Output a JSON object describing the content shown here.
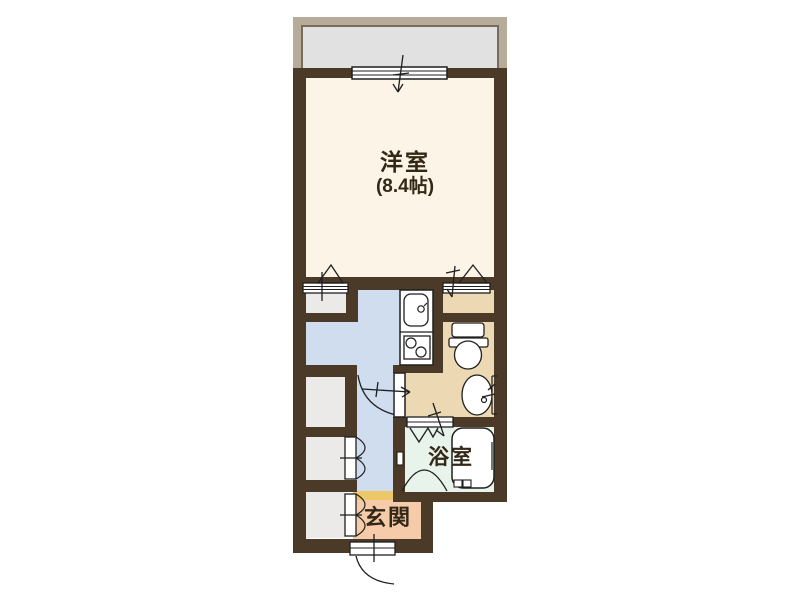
{
  "floor_plan": {
    "background": "#ffffff",
    "wall_color": "#4b3a28",
    "rooms": {
      "balcony": {
        "label": "",
        "fill": "#e1e1e1",
        "border": "#b7ab9a"
      },
      "western_room": {
        "label": "洋室",
        "size": "(8.4帖)",
        "fill": "#fcf4e6"
      },
      "kitchen_hallway": {
        "label": "",
        "fill": "#cfddef"
      },
      "washroom_toilet": {
        "label": "",
        "fill": "#ecd8b2"
      },
      "bathroom": {
        "label": "浴室",
        "fill": "#e7f3eb"
      },
      "entrance": {
        "label": "玄関",
        "fill": "#f6cba9",
        "step_color": "#edc868"
      },
      "closets": {
        "label": "",
        "fill": "#eceae8"
      }
    },
    "fixtures": [
      "window",
      "folding-closet-door",
      "hinged-door",
      "folding-bath-door",
      "kitchen-sink",
      "gas-stove",
      "toilet",
      "washbasin",
      "bathtub",
      "entrance-door"
    ]
  }
}
